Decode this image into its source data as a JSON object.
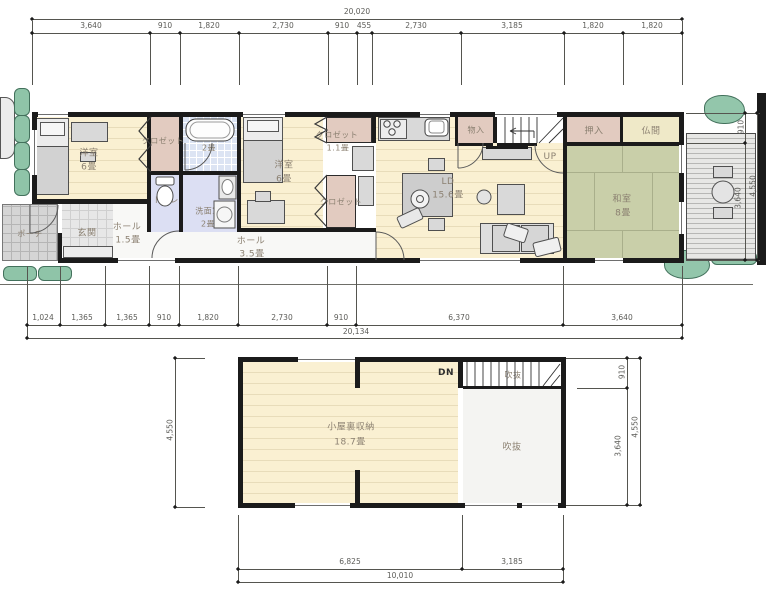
{
  "f1": {
    "bedroom1": "洋室",
    "bedroom1_s": "6畳",
    "closet1": "クロゼット",
    "bath": "浴室",
    "bath_s": "2畳",
    "toilet": "トイレ",
    "wash": "洗面室",
    "wash_s": "2畳",
    "porch": "ポーチ",
    "entrance": "玄関",
    "hall1": "ホール",
    "hall1_s": "1.5畳",
    "bedroom2": "洋室",
    "bedroom2_s": "6畳",
    "closet2": "クロゼット",
    "closet2_s": "1.1畳",
    "closet3": "クロゼット",
    "hall2": "ホール",
    "hall2_s": "3.5畳",
    "monoire": "物入",
    "up": "UP",
    "ld": "LD",
    "ld_s": "15.6畳",
    "oshiire": "押入",
    "butsuma": "仏間",
    "washitsu": "和室",
    "washitsu_s": "8畳"
  },
  "f2": {
    "attic": "小屋裏収納",
    "attic_s": "18.7畳",
    "stairwell": "吹抜",
    "void": "吹抜",
    "dn": "DN"
  },
  "dims": {
    "f1_top_total": "20,020",
    "f1_top": [
      "3,640",
      "910",
      "1,820",
      "2,730",
      "910",
      "455",
      "2,730",
      "3,185",
      "1,820",
      "1,820"
    ],
    "f1_bottom_total": "20,134",
    "f1_bottom": [
      "1,024",
      "1,365",
      "1,365",
      "910",
      "1,820",
      "2,730",
      "910",
      "6,370",
      "3,640"
    ],
    "f1_right": [
      "910",
      "3,640"
    ],
    "f1_right_total": "4,550",
    "f2_left_total": "4,550",
    "f2_right": [
      "910",
      "3,640"
    ],
    "f2_right_total": "4,550",
    "f2_bottom": [
      "6,825",
      "3,185"
    ],
    "f2_bottom_total": "10,010"
  },
  "colors": {
    "wood_floor": "#faf0d2",
    "closet": "#e2cbc0",
    "tatami": "#c9cfa9",
    "bath_tile": "#dce4f3",
    "wet_room": "#dcdff3",
    "porch_tile": "#d5d5d5",
    "greenery": "#8fc4a8",
    "wall": "#1b1b1b"
  }
}
